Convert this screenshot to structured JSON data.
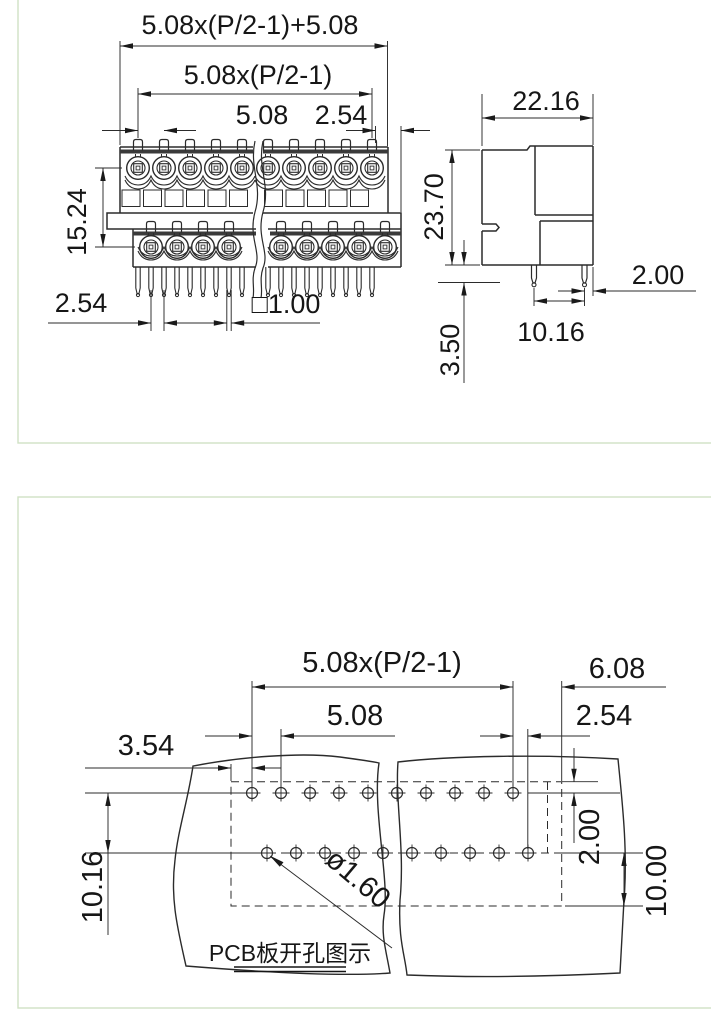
{
  "page": {
    "background": "#ffffff",
    "panel_border_color": "#cfe2c4",
    "line_color": "#2b2b2b"
  },
  "top_panel": {
    "front_view": {
      "labels": {
        "overall_width": "5.08x(P/2-1)+5.08",
        "contact_span": "5.08x(P/2-1)",
        "contact_pitch": "5.08",
        "end_margin": "2.54",
        "row_spacing": "15.24",
        "pin_pitch": "2.54",
        "pin_cross_section": "□1.00"
      },
      "contacts_per_row": 10,
      "pin_count": 18
    },
    "side_view": {
      "labels": {
        "depth": "22.16",
        "height": "23.70",
        "pin_protrusion": "3.50",
        "pin_row_span": "10.16",
        "pin_to_edge": "2.00"
      },
      "pin_count": 2
    }
  },
  "bottom_panel": {
    "pcb_view": {
      "labels": {
        "hole_span": "5.08x(P/2-1)",
        "edge_offset": "6.08",
        "hole_pitch": "5.08",
        "row_stagger": "2.54",
        "outline_margin": "3.54",
        "row_to_outline": "2.00",
        "outline_depth": "10.00",
        "row_spacing": "10.16",
        "hole_diameter": "ø1.60"
      },
      "holes_per_row": 10,
      "caption": "PCB板开孔图示"
    }
  }
}
